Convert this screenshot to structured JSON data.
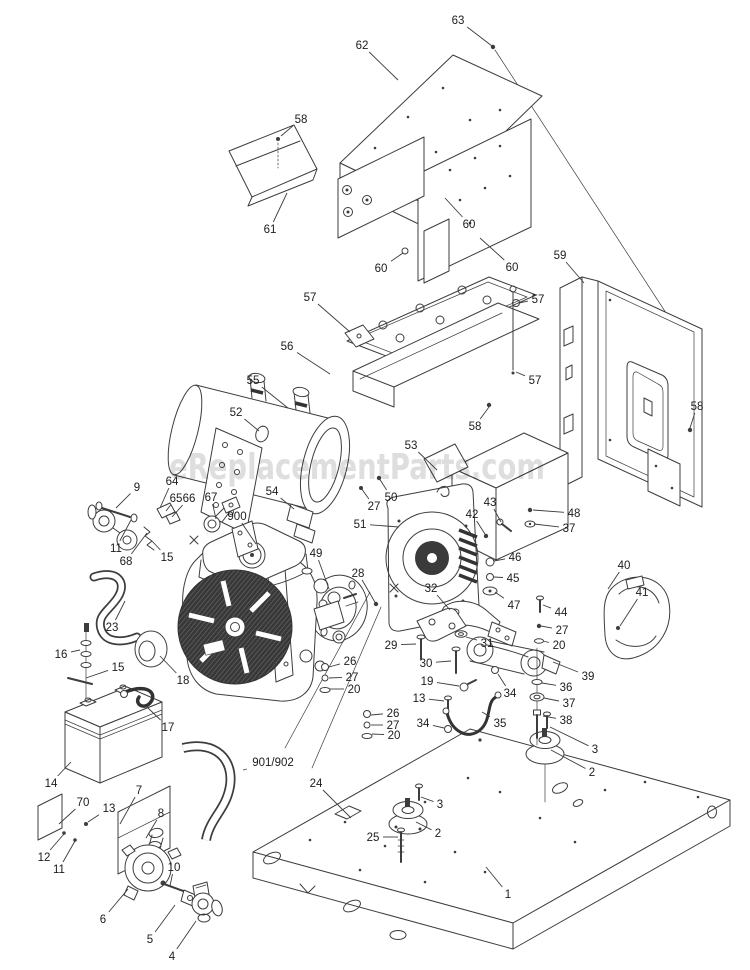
{
  "watermark": {
    "text": "eReplacementParts.com",
    "color": "#c3c3c3"
  },
  "diagram": {
    "title": "Generator exploded parts diagram",
    "line_color": "#3d3d3d",
    "label_color": "#1c1c1c",
    "labels": [
      {
        "t": "63",
        "x": 458,
        "y": 20,
        "tx": 492,
        "ty": 46
      },
      {
        "t": "62",
        "x": 362,
        "y": 45,
        "tx": 398,
        "ty": 80
      },
      {
        "t": "58",
        "x": 301,
        "y": 119,
        "tx": 281,
        "ty": 136
      },
      {
        "t": "61",
        "x": 270,
        "y": 229,
        "tx": 287,
        "ty": 193
      },
      {
        "t": "60",
        "x": 469,
        "y": 224,
        "tx": 445,
        "ty": 198
      },
      {
        "t": "60",
        "x": 381,
        "y": 268,
        "tx": 403,
        "ty": 253
      },
      {
        "t": "60",
        "x": 512,
        "y": 267,
        "tx": 480,
        "ty": 238
      },
      {
        "t": "59",
        "x": 560,
        "y": 255,
        "tx": 584,
        "ty": 283
      },
      {
        "t": "57",
        "x": 310,
        "y": 297,
        "tx": 350,
        "ty": 332
      },
      {
        "t": "57",
        "x": 538,
        "y": 299,
        "tx": 519,
        "ty": 303
      },
      {
        "t": "57",
        "x": 535,
        "y": 380,
        "tx": 516,
        "ty": 372
      },
      {
        "t": "56",
        "x": 287,
        "y": 346,
        "tx": 330,
        "ty": 374
      },
      {
        "t": "55",
        "x": 253,
        "y": 380,
        "tx": 288,
        "ty": 408
      },
      {
        "t": "52",
        "x": 236,
        "y": 412,
        "tx": 259,
        "ty": 431
      },
      {
        "t": "58",
        "x": 475,
        "y": 426,
        "tx": 489,
        "ty": 407
      },
      {
        "t": "58",
        "x": 697,
        "y": 406,
        "tx": 690,
        "ty": 428
      },
      {
        "t": "53",
        "x": 411,
        "y": 445,
        "tx": 437,
        "ty": 470
      },
      {
        "t": "9",
        "x": 137,
        "y": 487,
        "tx": 116,
        "ty": 508
      },
      {
        "t": "64",
        "x": 172,
        "y": 481,
        "tx": 160,
        "ty": 508
      },
      {
        "t": "65",
        "x": 176,
        "y": 498,
        "tx": 166,
        "ty": 511
      },
      {
        "t": "66",
        "x": 189,
        "y": 498,
        "tx": 172,
        "ty": 517
      },
      {
        "t": "67",
        "x": 211,
        "y": 497,
        "tx": 216,
        "ty": 519
      },
      {
        "t": "900",
        "x": 237,
        "y": 516,
        "tx": 256,
        "ty": 544
      },
      {
        "t": "11",
        "x": 116,
        "y": 548,
        "tx": 131,
        "ty": 520
      },
      {
        "t": "68",
        "x": 126,
        "y": 561,
        "tx": 147,
        "ty": 533
      },
      {
        "t": "15",
        "x": 167,
        "y": 557,
        "tx": 152,
        "ty": 541
      },
      {
        "t": "23",
        "x": 112,
        "y": 627,
        "tx": 125,
        "ty": 601
      },
      {
        "t": "16",
        "x": 61,
        "y": 654,
        "tx": 80,
        "ty": 650
      },
      {
        "t": "15",
        "x": 118,
        "y": 667,
        "tx": 86,
        "ty": 678
      },
      {
        "t": "18",
        "x": 183,
        "y": 680,
        "tx": 160,
        "ty": 656
      },
      {
        "t": "17",
        "x": 168,
        "y": 727,
        "tx": 148,
        "ty": 708
      },
      {
        "t": "14",
        "x": 51,
        "y": 783,
        "tx": 71,
        "ty": 762
      },
      {
        "t": "54",
        "x": 272,
        "y": 491,
        "tx": 294,
        "ty": 509
      },
      {
        "t": "27",
        "x": 374,
        "y": 506,
        "tx": 361,
        "ty": 488
      },
      {
        "t": "50",
        "x": 391,
        "y": 497,
        "tx": 379,
        "ty": 478
      },
      {
        "t": "51",
        "x": 360,
        "y": 524,
        "tx": 399,
        "ty": 527
      },
      {
        "t": "49",
        "x": 316,
        "y": 553,
        "tx": 329,
        "ty": 589
      },
      {
        "t": "28",
        "x": 358,
        "y": 573,
        "tx": 376,
        "ty": 604
      },
      {
        "t": "42",
        "x": 472,
        "y": 514,
        "tx": 485,
        "ty": 534
      },
      {
        "t": "43",
        "x": 490,
        "y": 502,
        "tx": 501,
        "ty": 522
      },
      {
        "t": "48",
        "x": 574,
        "y": 513,
        "tx": 533,
        "ty": 510
      },
      {
        "t": "37",
        "x": 569,
        "y": 528,
        "tx": 534,
        "ty": 524
      },
      {
        "t": "46",
        "x": 515,
        "y": 557,
        "tx": 494,
        "ty": 561
      },
      {
        "t": "45",
        "x": 513,
        "y": 578,
        "tx": 494,
        "ty": 577
      },
      {
        "t": "47",
        "x": 514,
        "y": 605,
        "tx": 495,
        "ty": 592
      },
      {
        "t": "40",
        "x": 624,
        "y": 565,
        "tx": 608,
        "ty": 589
      },
      {
        "t": "41",
        "x": 642,
        "y": 592,
        "tx": 620,
        "ty": 626
      },
      {
        "t": "32",
        "x": 431,
        "y": 588,
        "tx": 450,
        "ty": 610
      },
      {
        "t": "29",
        "x": 391,
        "y": 645,
        "tx": 416,
        "ty": 644
      },
      {
        "t": "30",
        "x": 426,
        "y": 663,
        "tx": 451,
        "ty": 661
      },
      {
        "t": "31",
        "x": 487,
        "y": 643,
        "tx": 466,
        "ty": 637
      },
      {
        "t": "26",
        "x": 350,
        "y": 661,
        "tx": 329,
        "ty": 667
      },
      {
        "t": "27",
        "x": 352,
        "y": 677,
        "tx": 329,
        "ty": 678
      },
      {
        "t": "20",
        "x": 354,
        "y": 689,
        "tx": 330,
        "ty": 689
      },
      {
        "t": "19",
        "x": 427,
        "y": 681,
        "tx": 459,
        "ty": 686
      },
      {
        "t": "13",
        "x": 419,
        "y": 698,
        "tx": 444,
        "ty": 701
      },
      {
        "t": "26",
        "x": 393,
        "y": 713,
        "tx": 371,
        "ty": 715
      },
      {
        "t": "27",
        "x": 393,
        "y": 725,
        "tx": 371,
        "ty": 725
      },
      {
        "t": "20",
        "x": 394,
        "y": 735,
        "tx": 372,
        "ty": 734
      },
      {
        "t": "34",
        "x": 423,
        "y": 723,
        "tx": 444,
        "ty": 728
      },
      {
        "t": "35",
        "x": 500,
        "y": 723,
        "tx": 482,
        "ty": 712
      },
      {
        "t": "34",
        "x": 510,
        "y": 693,
        "tx": 498,
        "ty": 674
      },
      {
        "t": "44",
        "x": 561,
        "y": 612,
        "tx": 543,
        "ty": 605
      },
      {
        "t": "27",
        "x": 562,
        "y": 630,
        "tx": 541,
        "ty": 626
      },
      {
        "t": "20",
        "x": 559,
        "y": 645,
        "tx": 543,
        "ty": 641
      },
      {
        "t": "39",
        "x": 588,
        "y": 676,
        "tx": 553,
        "ty": 662
      },
      {
        "t": "36",
        "x": 566,
        "y": 687,
        "tx": 542,
        "ty": 683
      },
      {
        "t": "37",
        "x": 569,
        "y": 703,
        "tx": 544,
        "ty": 698
      },
      {
        "t": "38",
        "x": 566,
        "y": 720,
        "tx": 543,
        "ty": 716
      },
      {
        "t": "3",
        "x": 595,
        "y": 749,
        "tx": 550,
        "ty": 727
      },
      {
        "t": "2",
        "x": 592,
        "y": 772,
        "tx": 551,
        "ty": 750
      },
      {
        "t": "901/902",
        "x": 273,
        "y": 762,
        "tx": 243,
        "ty": 770
      },
      {
        "t": "24",
        "x": 316,
        "y": 783,
        "tx": 351,
        "ty": 818
      },
      {
        "t": "3",
        "x": 440,
        "y": 804,
        "tx": 421,
        "ty": 797
      },
      {
        "t": "2",
        "x": 438,
        "y": 833,
        "tx": 416,
        "ty": 822
      },
      {
        "t": "25",
        "x": 373,
        "y": 837,
        "tx": 398,
        "ty": 837
      },
      {
        "t": "1",
        "x": 508,
        "y": 894,
        "tx": 486,
        "ty": 867
      },
      {
        "t": "70",
        "x": 83,
        "y": 802,
        "tx": 59,
        "ty": 824
      },
      {
        "t": "13",
        "x": 109,
        "y": 808,
        "tx": 88,
        "ty": 822
      },
      {
        "t": "7",
        "x": 139,
        "y": 790,
        "tx": 120,
        "ty": 824
      },
      {
        "t": "8",
        "x": 161,
        "y": 813,
        "tx": 146,
        "ty": 838
      },
      {
        "t": "12",
        "x": 44,
        "y": 857,
        "tx": 64,
        "ty": 834
      },
      {
        "t": "11",
        "x": 59,
        "y": 869,
        "tx": 75,
        "ty": 841
      },
      {
        "t": "10",
        "x": 174,
        "y": 867,
        "tx": 170,
        "ty": 886
      },
      {
        "t": "6",
        "x": 103,
        "y": 919,
        "tx": 128,
        "ty": 889
      },
      {
        "t": "5",
        "x": 150,
        "y": 939,
        "tx": 175,
        "ty": 905
      },
      {
        "t": "4",
        "x": 172,
        "y": 956,
        "tx": 196,
        "ty": 921
      }
    ]
  }
}
